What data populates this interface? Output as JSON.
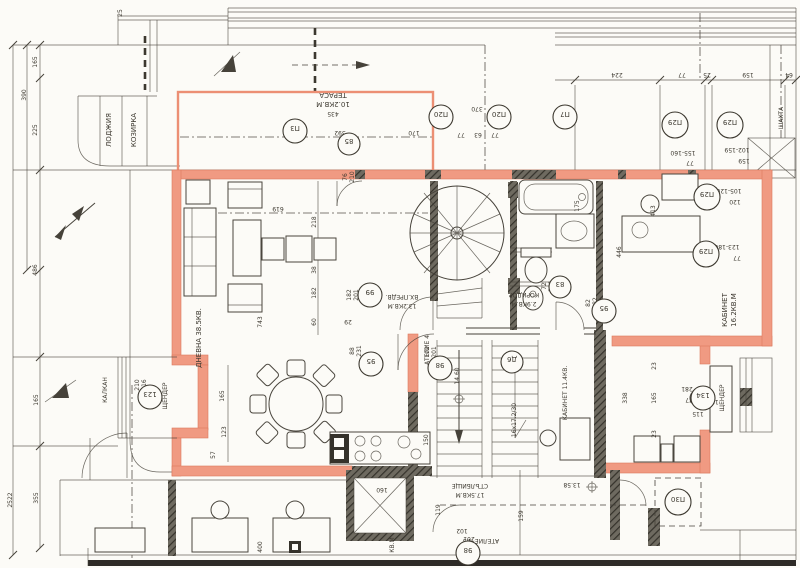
{
  "drawing": {
    "type": "architectural floor plan (scanned)",
    "accent_wall_color": "#F09A82",
    "ink_color": "#46423A"
  },
  "labels": {
    "lodzhia": "ЛОДЖИЯ",
    "kozirka": "КОЗИРКА",
    "terasa": "ТЕРАСА",
    "terasa_area": "10.2КВ.М",
    "terasa_w": "435",
    "dnevna": "ДНЕВНА 38.5КВ.",
    "vestibule": "ВХ.ПРЕДВ.",
    "vestibule_area": "13.2КВ.М",
    "koridor": "КОРИДОР",
    "koridor_area": "2.9КВ.М",
    "kabinet1": "КАБИНЕТ",
    "kabinet1_area": "16.2КВ.М",
    "kabinet2": "КАБИНЕТ 11.4КВ.",
    "stair_room": "СТЪЛБИЩЕ",
    "stair_area": "17.5КВ.М",
    "atelie4": "АТЕЛИЕ 4",
    "atelie3": "АТЕЛИЕ №3",
    "shtender_left": "ЩЕНДЕР",
    "shtender_right": "ЩЕНДЕР",
    "shahta": "ШАХТА",
    "kalkan": "КАЛКАН",
    "kvm": "КВ.М",
    "level_up": "14.60",
    "level_down": "13.58",
    "stair_spec": "16x17.2/30",
    "lift": "160"
  },
  "dims": {
    "left": [
      "2522",
      "390",
      "165",
      "225",
      "486",
      "165",
      "355"
    ],
    "top": [
      "224",
      "77",
      "25",
      "159",
      "64",
      "25"
    ],
    "terrace": [
      "392",
      "170",
      "370",
      "77",
      "63",
      "77"
    ],
    "living": [
      "619",
      "218",
      "38",
      "182",
      "60",
      "743",
      "76",
      "210"
    ],
    "dining": [
      "165",
      "123",
      "57",
      "29",
      "400"
    ],
    "stairzone": [
      "150",
      "119",
      "159"
    ],
    "right": [
      "175",
      "413",
      "446",
      "105-120",
      "120",
      "123-180",
      "77",
      "155-160",
      "77",
      "102-159",
      "159",
      "338",
      "165",
      "23",
      "23",
      "281",
      "177",
      "115",
      "182"
    ],
    "doors": [
      "182",
      "201",
      "88",
      "231",
      "102",
      "201",
      "72",
      "201",
      "82",
      "182",
      "210",
      "216",
      "102",
      "201"
    ]
  },
  "marks": [
    "П3",
    "85",
    "П20",
    "П20",
    "П7",
    "П29",
    "П29",
    "П29",
    "П29",
    "99",
    "95",
    "98",
    "Д6",
    "83",
    "95",
    "123",
    "134",
    "П30",
    "98"
  ]
}
